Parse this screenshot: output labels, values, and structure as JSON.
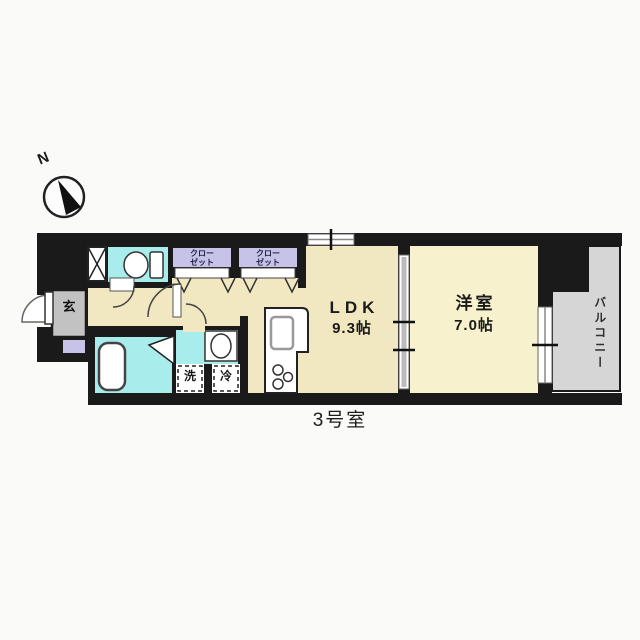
{
  "compass": {
    "north_label": "N"
  },
  "plan": {
    "unit_label": "3号室",
    "entrance_label": "玄",
    "closet_1": "クロー\nゼット",
    "closet_2": "クロー\nゼット",
    "ldk_name": "LDK",
    "ldk_size": "9.3帖",
    "western_room_name": "洋室",
    "western_room_size": "7.0帖",
    "balcony_label": "バルコニー",
    "washer_label": "洗",
    "fridge_label": "冷"
  },
  "colors": {
    "wall": "#1a1a1a",
    "floor_cream": "#f1e7c1",
    "western_room_floor": "#f7f1cd",
    "wet_area_cyan": "#a8ecec",
    "closet_lavender": "#c7c3e8",
    "entrance_gray": "#c2c2c2",
    "balcony_gray": "#d6d6d6"
  }
}
